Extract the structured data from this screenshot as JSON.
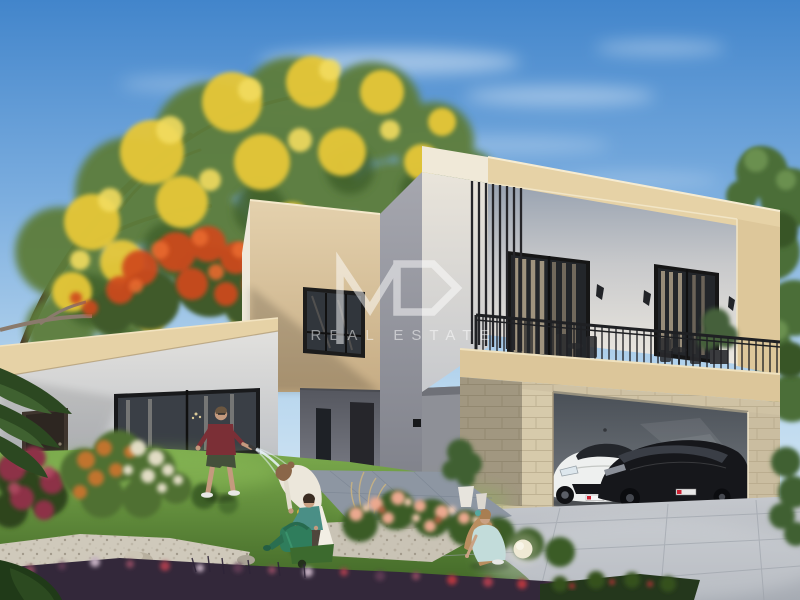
{
  "watermark": {
    "logo": "MD",
    "subtitle": "REAL ESTATE",
    "color": "#ffffff"
  },
  "palette": {
    "sky_top": "#4285cb",
    "sky_mid": "#7fb0e0",
    "sky_low": "#b9d7ee",
    "sky_horizon": "#e7f1f9",
    "cloud_white": "#ffffff",
    "foliage_green": "#5d7d3a",
    "foliage_dark": "#41602c",
    "foliage_light": "#79a04b",
    "flower_yellow": "#e6c737",
    "flower_yellow_light": "#f2dc5e",
    "flower_red": "#cf4a1e",
    "flower_red_light": "#e8692f",
    "flower_pink": "#eba98f",
    "flower_pink_light": "#f7cdb5",
    "flower_crimson": "#8d3046",
    "parapet_beige": "#e6d2a6",
    "stone_beige": "#cfc2a4",
    "wall_gray": "#9b9ca4",
    "garage_interior": "#4a5057",
    "driveway_gray": "#bcc0c6",
    "walkway_gray": "#8d96a2",
    "grass_green": "#649a3d",
    "gravel_beige": "#cfc9bb",
    "hedge_dark": "#33283a",
    "railing_black": "#1f2023",
    "car_white": "#eef0ef",
    "car_black": "#16171b",
    "man_shirt_maroon": "#7b2f36",
    "boy_shirt_teal": "#4a8f86",
    "girl_dress_blue": "#c2dcda",
    "woman_outfit_cream": "#ece7db",
    "watering_can_green": "#2f7d5c",
    "water_blue": "#eaf4fb",
    "skin_tone": "#c49a7e",
    "hair_brown": "#8a6648"
  },
  "scene": {
    "description": "3D exterior rendering of a modern two-storey villa with garden, balcony, double garage and a family gardening",
    "labels": {
      "sky": "Blue sky with wispy clouds",
      "yellow_tree": "Yellow flowering tree",
      "red_tree": "Red flowering tree",
      "bg_trees": "Green background trees",
      "villa": "Modern two-storey villa",
      "left_wing": "Single-storey left wing",
      "entry": "Recessed entrance porch",
      "upper_floor": "Upper floor with louvers and balcony",
      "balcony": "Balcony with black metal railing",
      "garage": "Double garage with two sports cars",
      "white_car": "White sports car",
      "black_car": "Black sports car",
      "driveway": "Paved concrete driveway",
      "walkway": "Entrance walkway",
      "garden": "Landscaped garden with flower beds",
      "man": "Man watering the lawn with a hose",
      "woman": "Woman gardening",
      "boy": "Boy with a green watering can",
      "girl": "Girl crouching by the flower bed",
      "garden_light": "Globe garden light"
    }
  }
}
